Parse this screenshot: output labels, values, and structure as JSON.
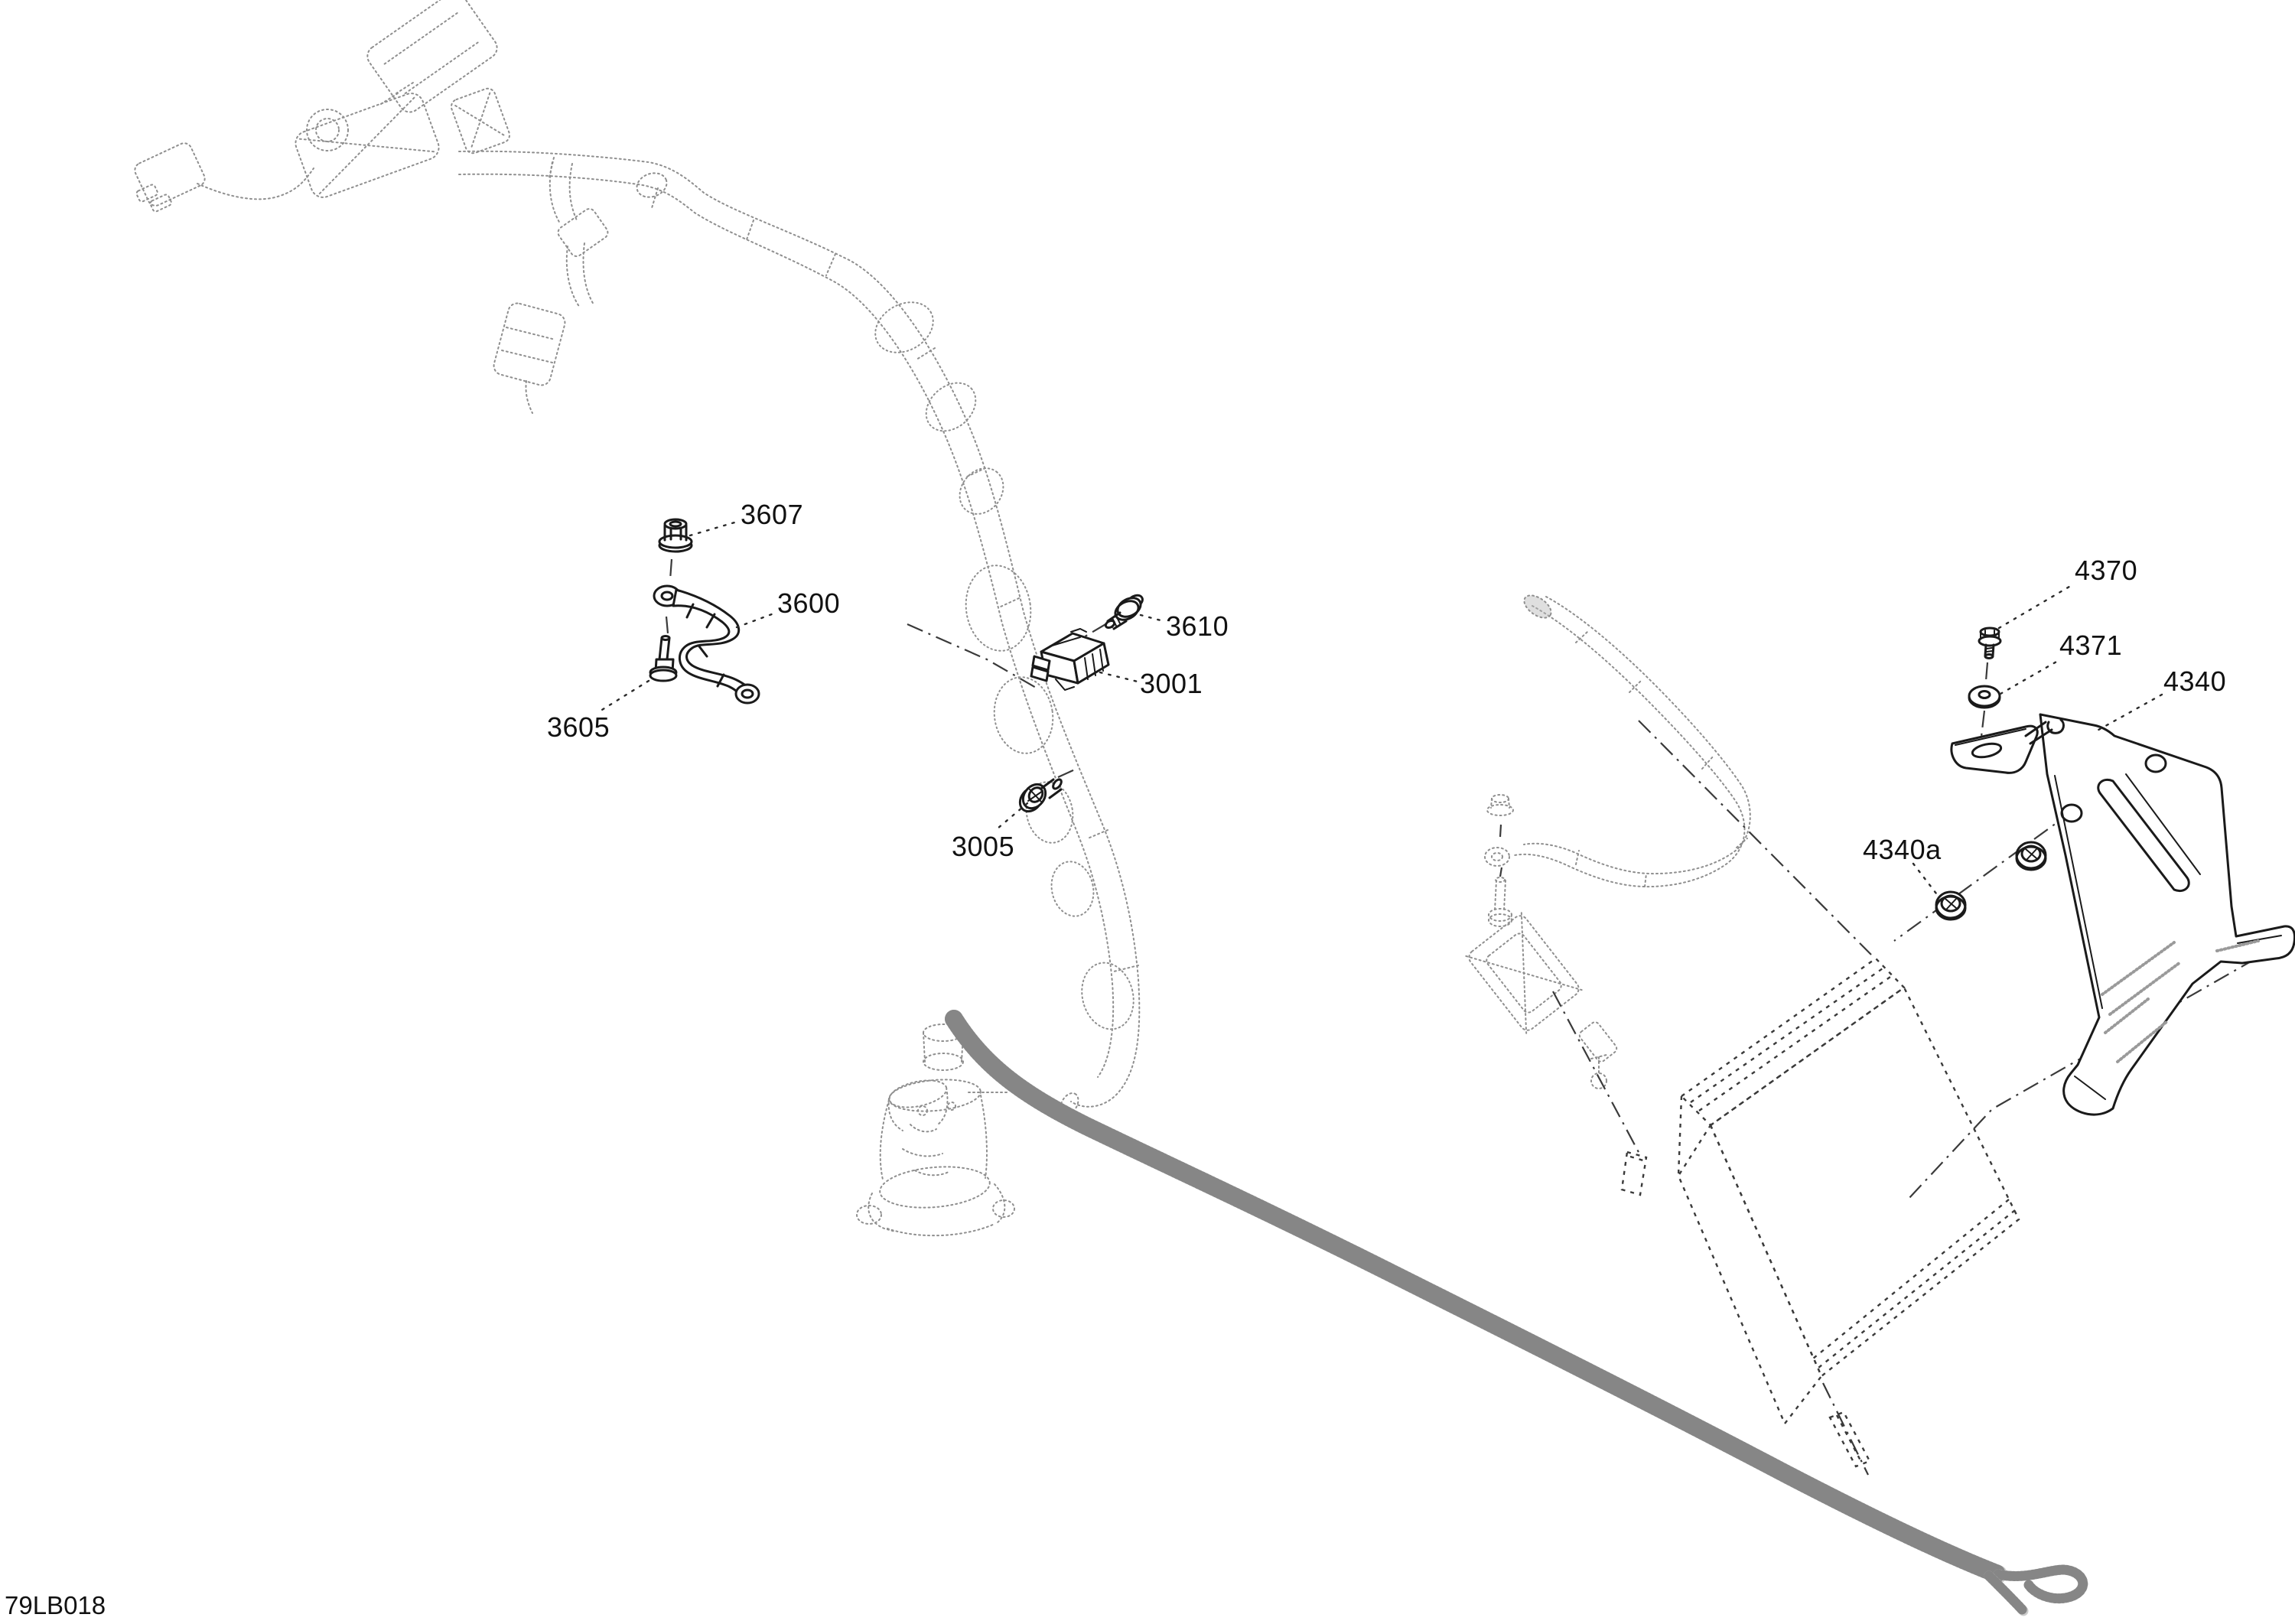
{
  "diagram": {
    "figure_code": "79LB018",
    "background_color": "#ffffff",
    "ink_color": "#1a1a1a",
    "reference_ink_color": "#8f8f8f",
    "callouts": [
      {
        "label": "3607"
      },
      {
        "label": "3600"
      },
      {
        "label": "3605"
      },
      {
        "label": "3610"
      },
      {
        "label": "3001"
      },
      {
        "label": "3005"
      },
      {
        "label": "4370"
      },
      {
        "label": "4371"
      },
      {
        "label": "4340"
      },
      {
        "label": "4340a"
      }
    ]
  }
}
